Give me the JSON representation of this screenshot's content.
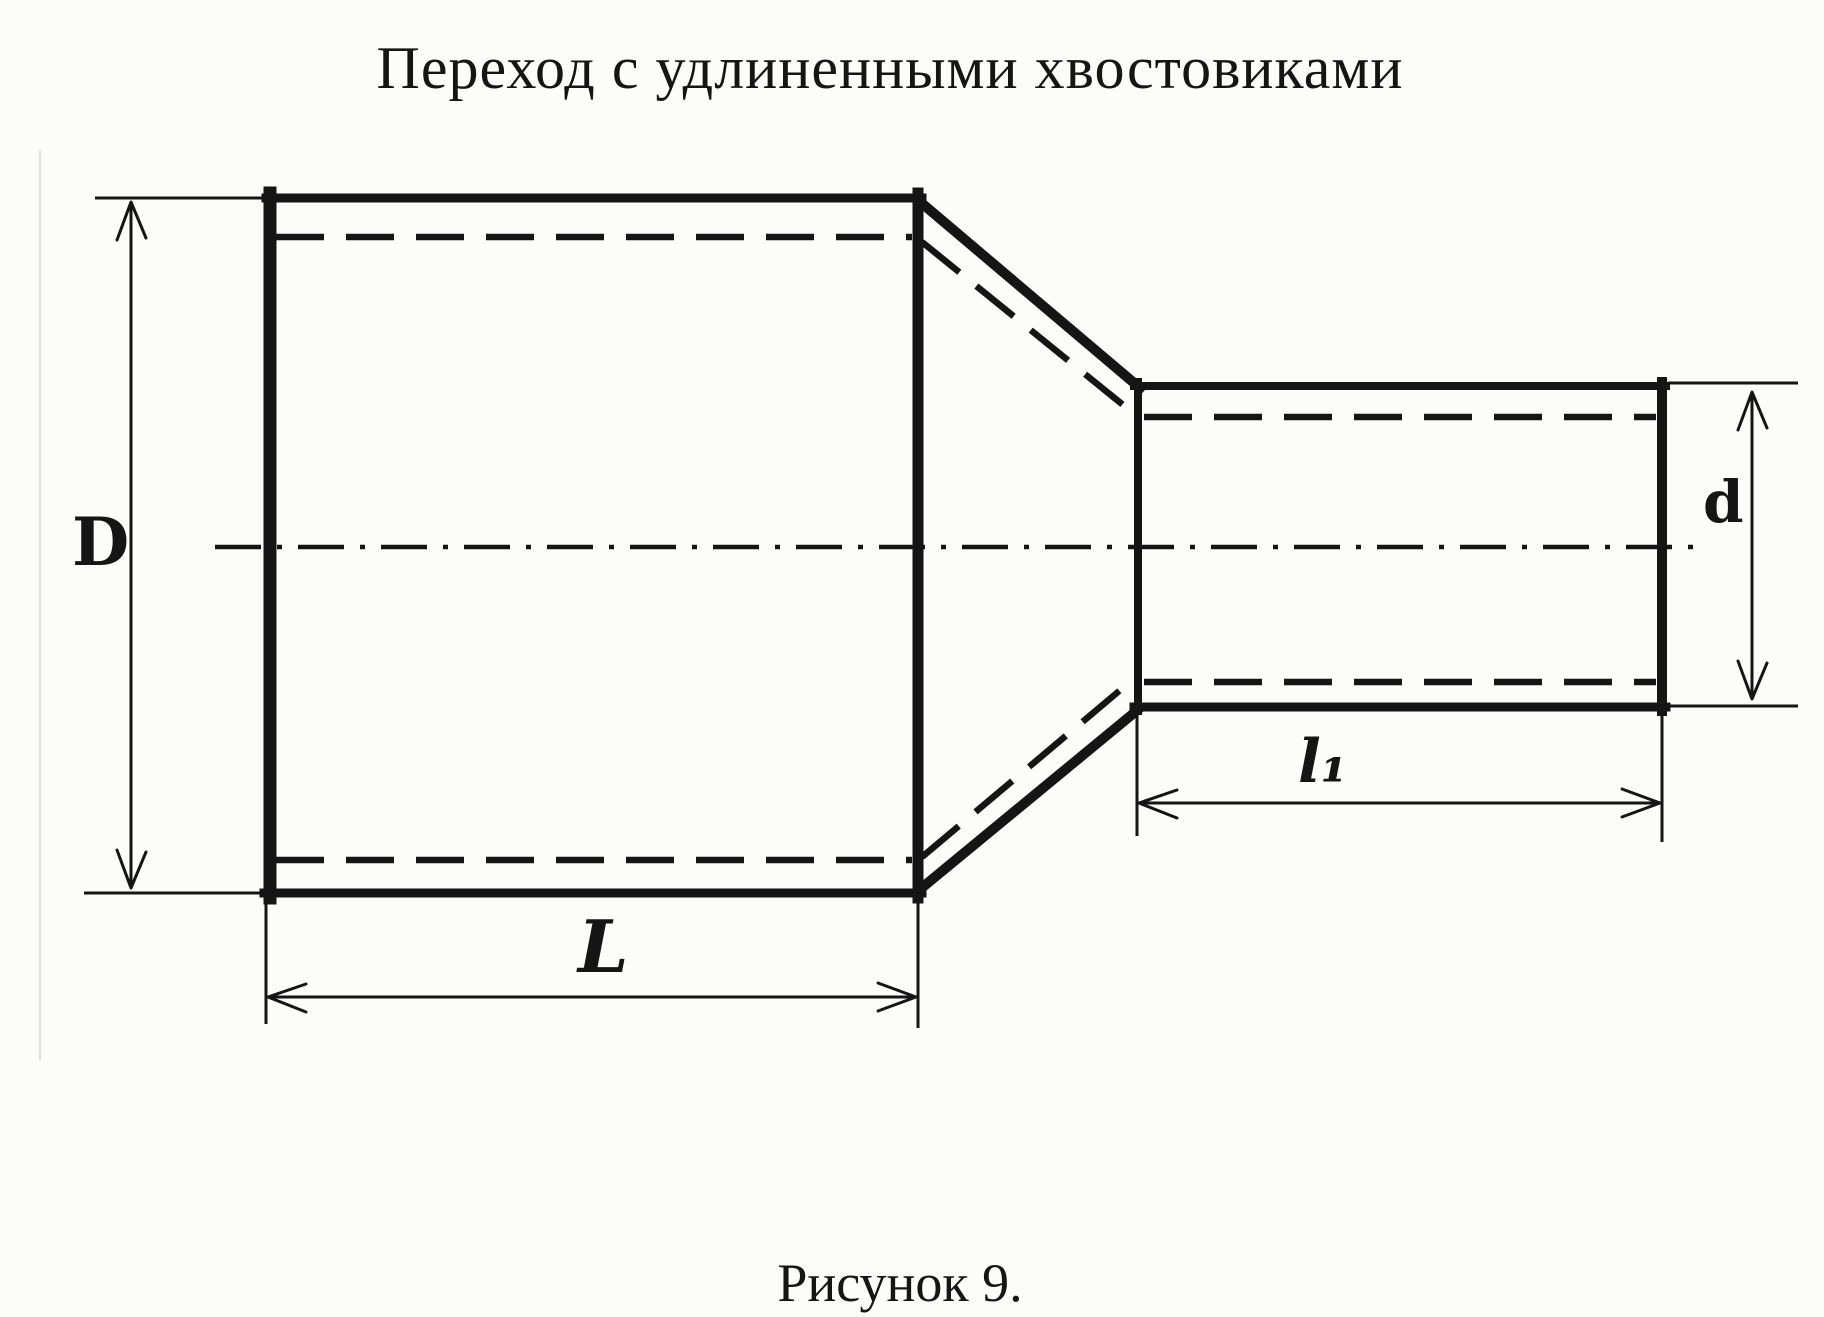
{
  "title": "Переход с удлиненными хвостовиками",
  "caption": "Рисунок 9.",
  "dimensions": {
    "large_diameter": "D",
    "large_length": "L",
    "small_diameter": "d",
    "small_length": "l₁"
  },
  "colors": {
    "ink": "#151515",
    "paper": "#fcfcfa"
  }
}
